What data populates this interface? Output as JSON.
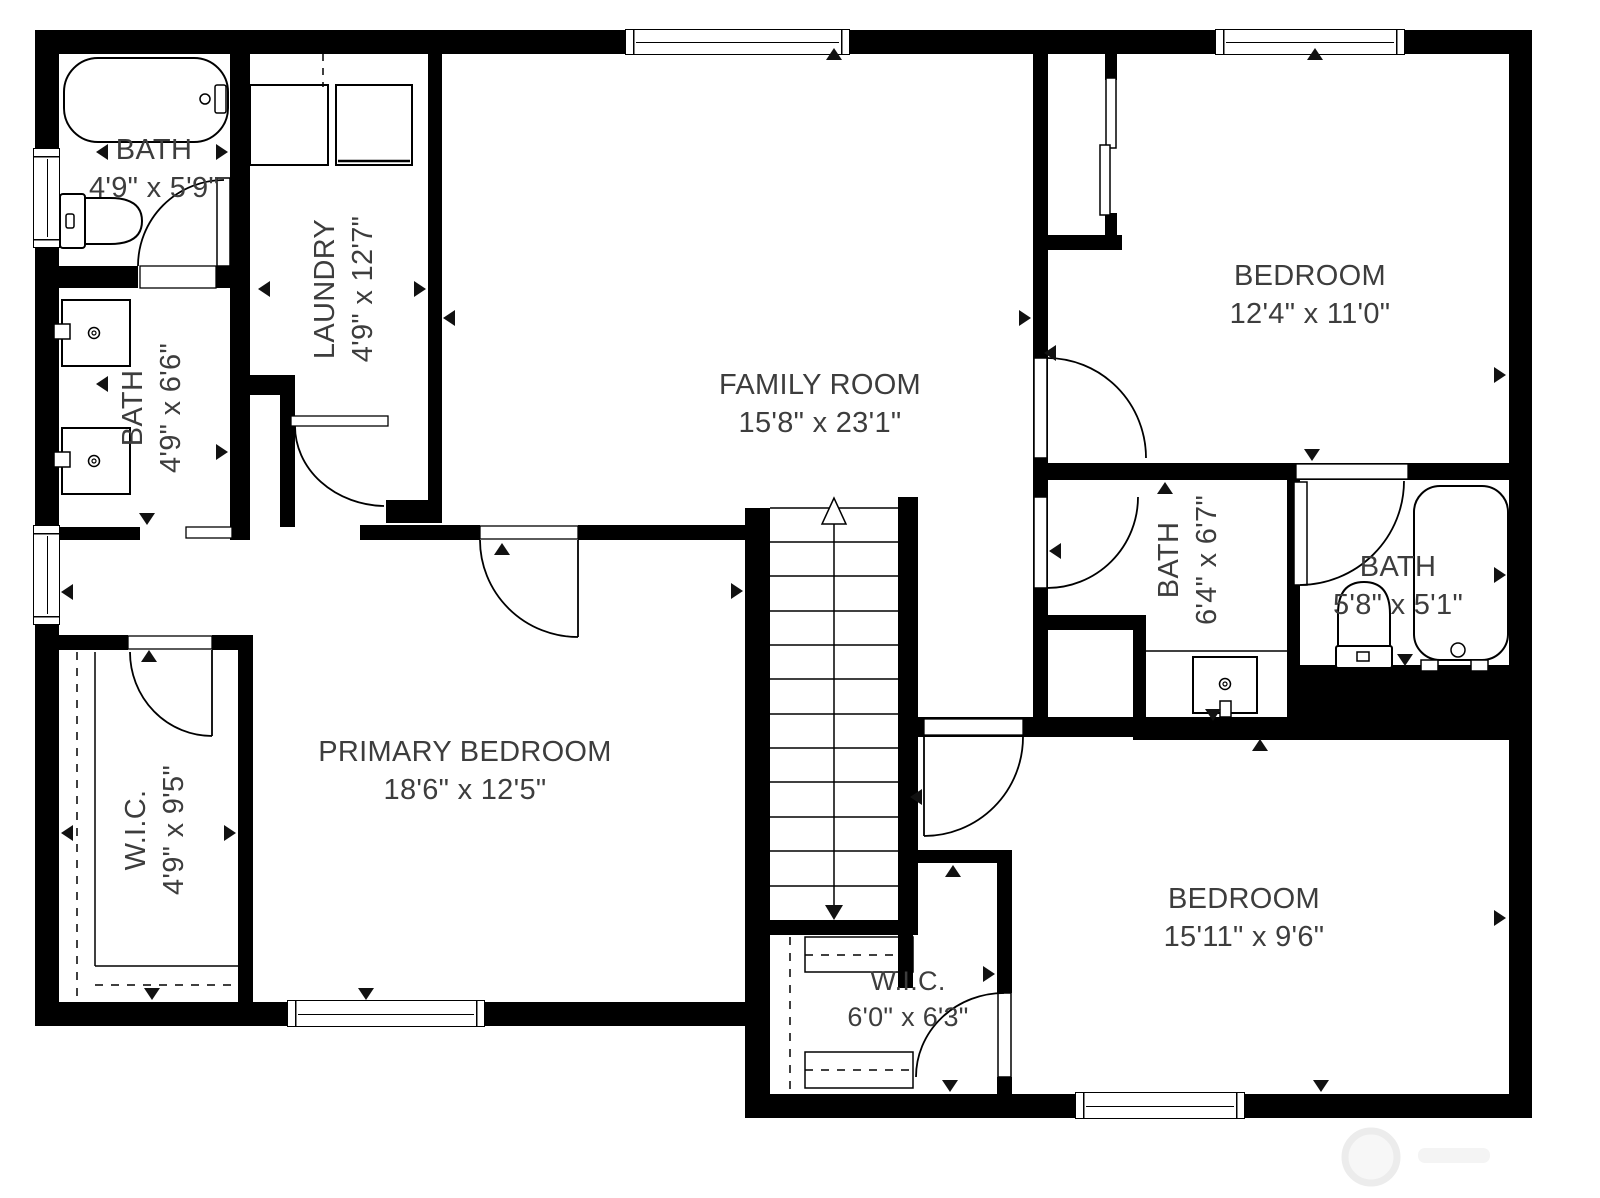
{
  "title": "Floor plan",
  "rooms": [
    {
      "id": "bath-top-left",
      "name": "BATH",
      "dims": "4'9\" x 5'9\""
    },
    {
      "id": "laundry",
      "name": "LAUNDRY",
      "dims": "4'9\" x 12'7\""
    },
    {
      "id": "family-room",
      "name": "FAMILY ROOM",
      "dims": "15'8\" x 23'1\""
    },
    {
      "id": "bedroom-top-right",
      "name": "BEDROOM",
      "dims": "12'4\" x 11'0\""
    },
    {
      "id": "bath-left-ensuite",
      "name": "BATH",
      "dims": "4'9\" x 6'6\""
    },
    {
      "id": "bath-hall",
      "name": "BATH",
      "dims": "6'4\" x 6'7\""
    },
    {
      "id": "bath-ensuite-right",
      "name": "BATH",
      "dims": "5'8\" x 5'1\""
    },
    {
      "id": "wic-left",
      "name": "W.I.C.",
      "dims": "4'9\" x 9'5\""
    },
    {
      "id": "primary-bedroom",
      "name": "PRIMARY BEDROOM",
      "dims": "18'6\" x 12'5\""
    },
    {
      "id": "wic-bottom",
      "name": "W.I.C.",
      "dims": "6'0\" x 6'3\""
    },
    {
      "id": "bedroom-bottom-right",
      "name": "BEDROOM",
      "dims": "15'11\" x 9'6\""
    }
  ],
  "fixtures": [
    "bathtub",
    "toilet",
    "sink",
    "double-vanity",
    "washer",
    "dryer",
    "stairs-up-arrow",
    "closet-rod",
    "sliding-closet-door"
  ],
  "colors": {
    "wall": "#000000",
    "background": "#ffffff",
    "text": "#3d3d3d",
    "watermark": "#f0f0f0"
  }
}
